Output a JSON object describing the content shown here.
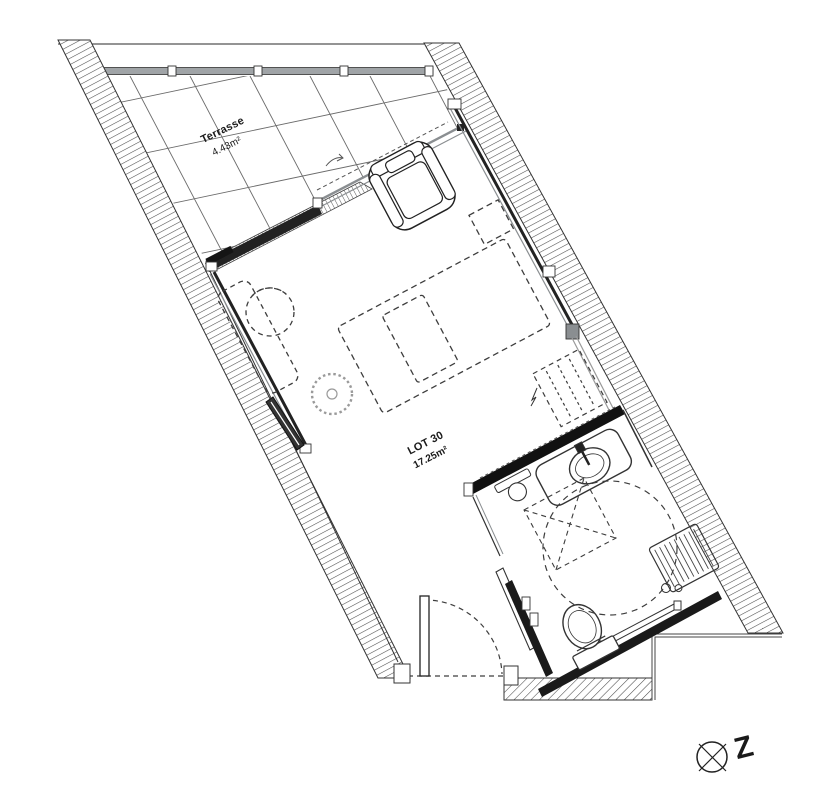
{
  "drawing": {
    "type": "architectural floor plan",
    "rooms": [
      {
        "name": "Terrasse",
        "area": "4.43m²"
      },
      {
        "name": "LOT 30",
        "area": "17.25m²"
      }
    ],
    "north_marker": {
      "letter": "Z"
    },
    "colors": {
      "background": "#ffffff",
      "line": "#2a2a2a",
      "wall_dark": "#1a1a1a",
      "railing_gray": "#a0a4a7",
      "glazing_gray": "#8a8e91",
      "hatch": "#4a4a4a",
      "dash": "#3d3d3d"
    }
  }
}
